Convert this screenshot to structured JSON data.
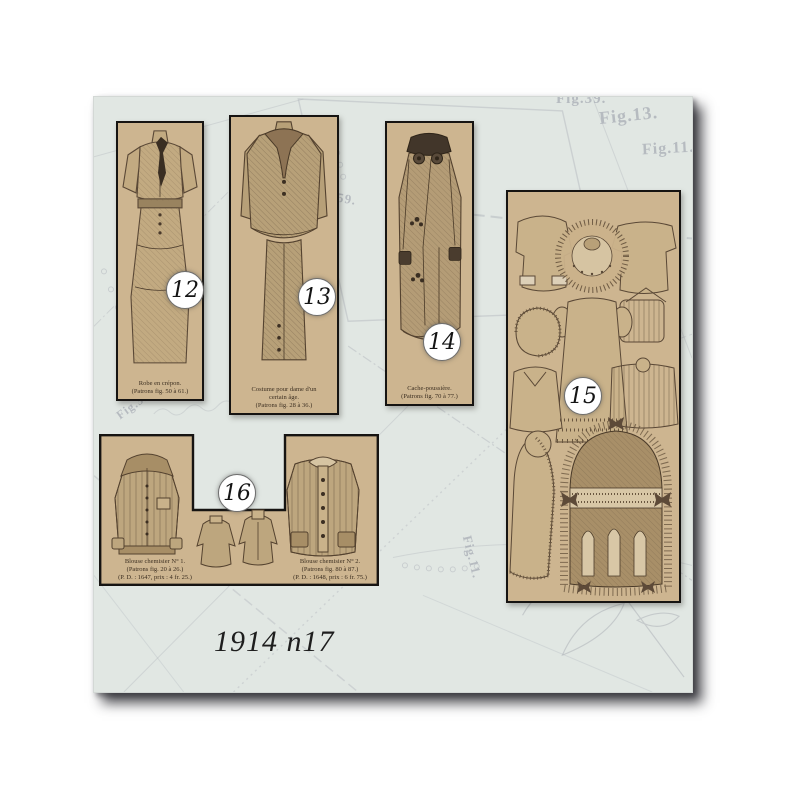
{
  "artwork": {
    "title": "1914 n17"
  },
  "palette": {
    "page_bg": "#e1e7e3",
    "panel_bg": "#cdb590",
    "ink": "#5a4836",
    "pattern_line": "#b5b9bf",
    "badge_bg": "#ffffff"
  },
  "panels": [
    {
      "id": "12",
      "number": "12",
      "caption_lines": [
        "Robe en crépon.",
        "(Patrons fig. 50 à 61.)"
      ]
    },
    {
      "id": "13",
      "number": "13",
      "caption_lines": [
        "Costume pour dame d'un",
        "certain âge.",
        "(Patrons fig. 28 à 36.)"
      ]
    },
    {
      "id": "14",
      "number": "14",
      "caption_lines": [
        "Cache-poussière.",
        "(Patrons fig. 70 à 77.)"
      ]
    },
    {
      "id": "15",
      "number": "15",
      "caption_lines": []
    },
    {
      "id": "16",
      "number": "16",
      "left_caption_lines": [
        "Blouse chemisier N° 1.",
        "(Patrons fig. 20 à 26.)",
        "(P. D. : 1647, prix : 4 fr. 25.)"
      ],
      "right_caption_lines": [
        "Blouse chemisier N° 2.",
        "(Patrons fig. 80 à 87.)",
        "(P. D. : 1648, prix : 6 fr. 75.)"
      ]
    }
  ],
  "background_labels": [
    {
      "text": "Fig.39."
    },
    {
      "text": "Fig.13."
    },
    {
      "text": "Fig.11."
    },
    {
      "text": "Fig.59."
    },
    {
      "text": "Fig.32."
    },
    {
      "text": "Fig.11."
    }
  ]
}
